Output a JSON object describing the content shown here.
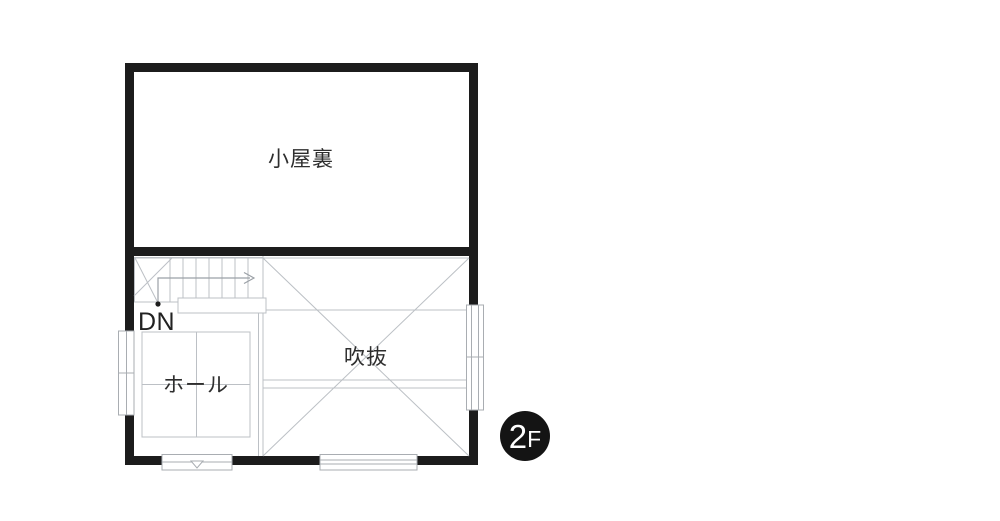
{
  "floor_plan": {
    "floor_badge": {
      "number": "2",
      "suffix": "F"
    },
    "rooms": {
      "attic": {
        "label": "小屋裏"
      },
      "hall": {
        "label": "ホール"
      },
      "void": {
        "label": "吹抜"
      }
    },
    "stairs": {
      "direction_label": "DN"
    }
  },
  "colors": {
    "wall": "#1c1c1c",
    "thin_line": "#bcc0c5",
    "window_frame": "#a9adb2",
    "text": "#2e2e2e",
    "badge_background": "#141414",
    "badge_text": "#ffffff",
    "background": "#ffffff"
  }
}
